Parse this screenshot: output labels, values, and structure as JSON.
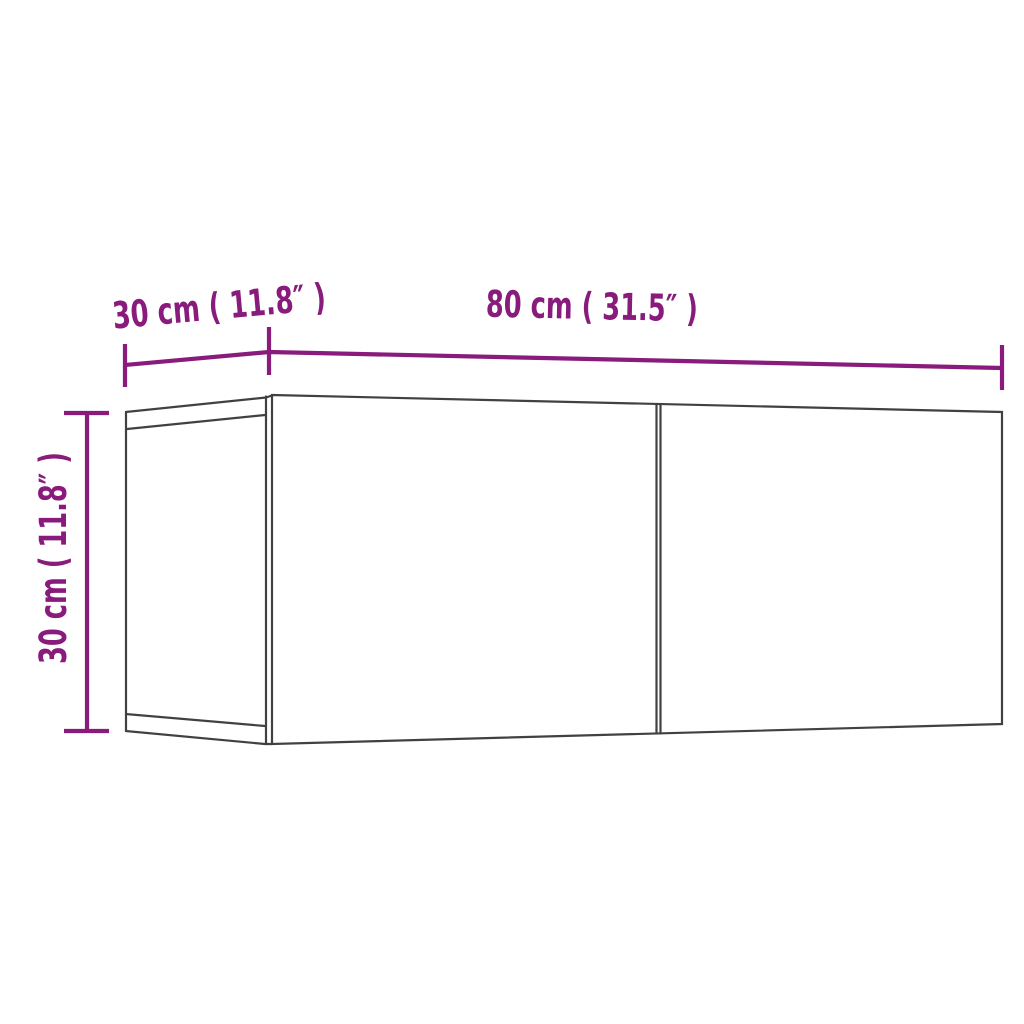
{
  "page": {
    "background_color": "#ffffff"
  },
  "diagram": {
    "colors": {
      "dimension": "#881b7b",
      "outline": "#414141"
    },
    "labels": {
      "depth": "30 cm ( 11.8″ )",
      "width": "80 cm ( 31.5″ )",
      "height": "30 cm ( 11.8″ )"
    },
    "values": {
      "depth_cm": 30,
      "depth_in": 11.8,
      "width_cm": 80,
      "width_in": 31.5,
      "height_cm": 30,
      "height_in": 11.8
    }
  }
}
